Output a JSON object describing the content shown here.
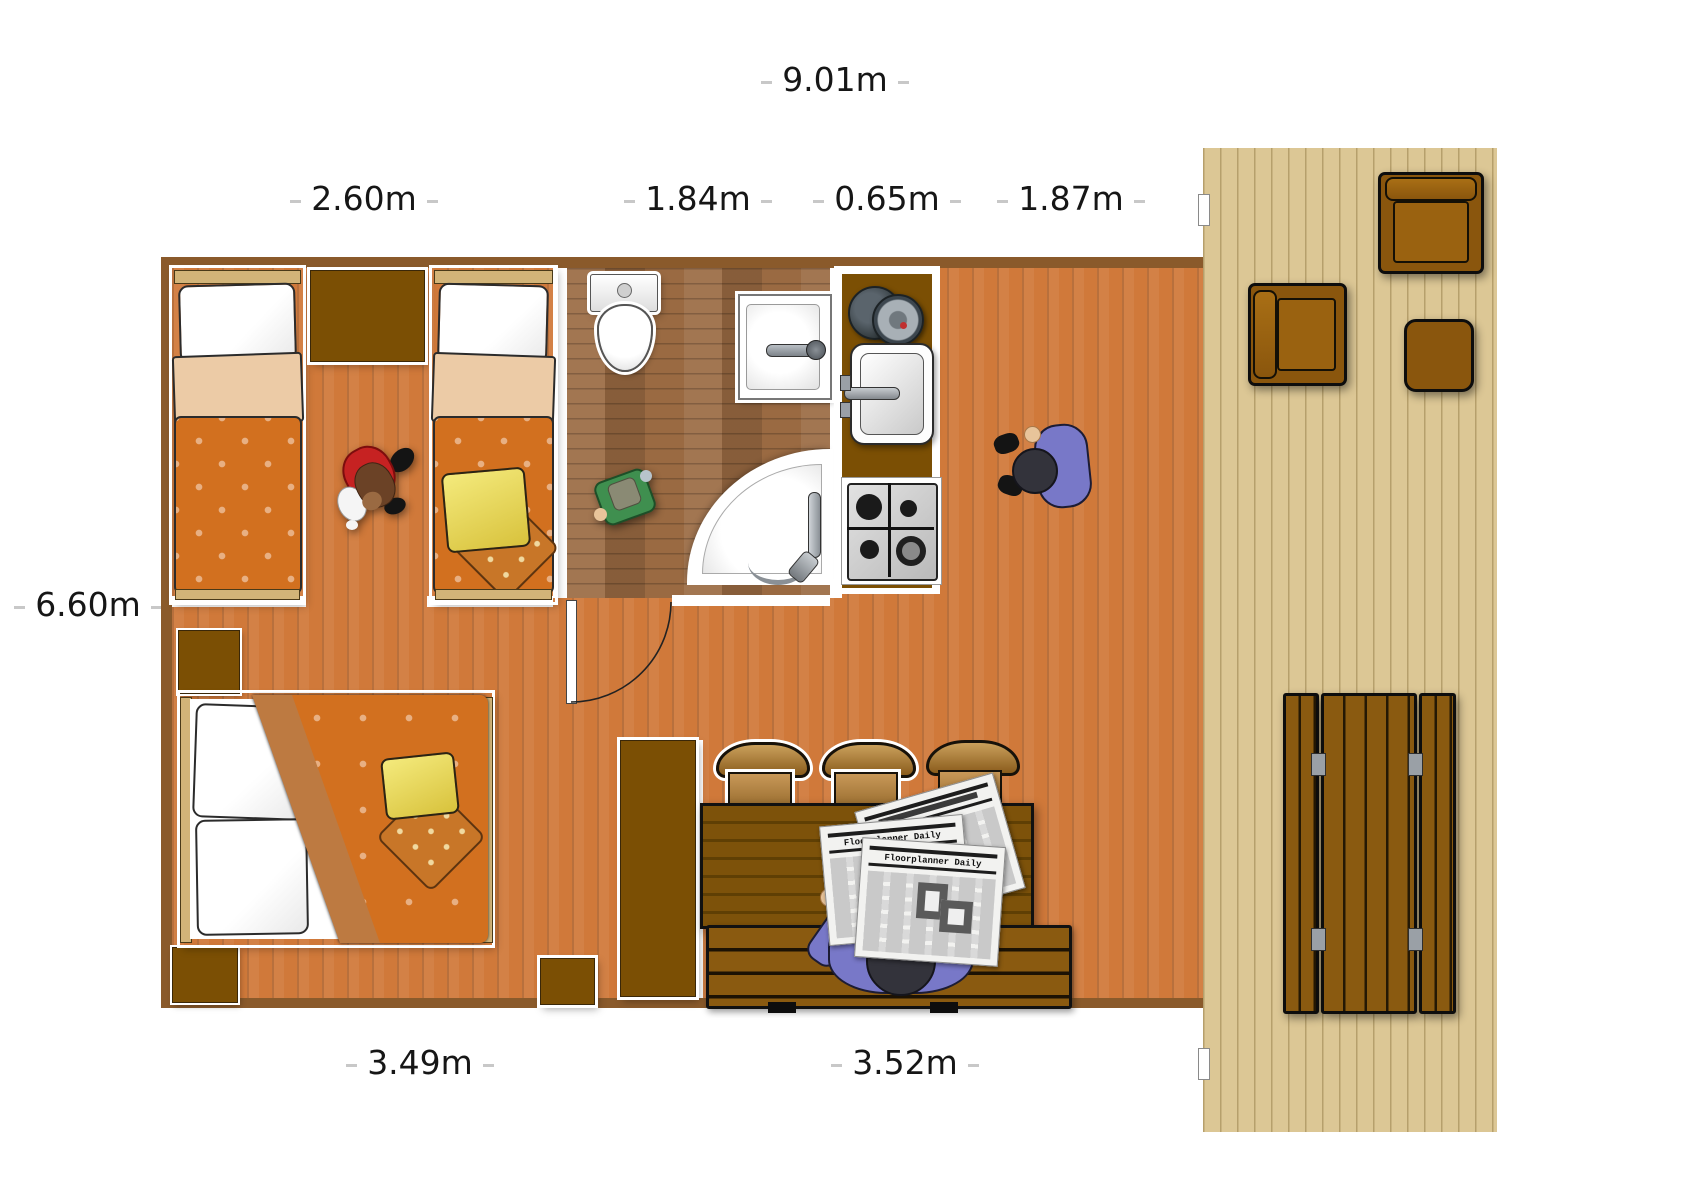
{
  "dimensions": {
    "top_total": "9.01m",
    "seg_bedroom": "2.60m",
    "seg_bathroom": "1.84m",
    "seg_kitchen": "0.65m",
    "seg_living": "1.87m",
    "left_height": "6.60m",
    "bottom_bedroom": "3.49m",
    "bottom_dining": "3.52m"
  },
  "newspaper": {
    "title_front": "Floorplanner Daily",
    "title_middle": "Floorplanner Daily"
  },
  "palette": {
    "floor_wood": "#d0793a",
    "bathroom_parquet": "#9a6a42",
    "deck_wood": "#dcc795",
    "wall_brown": "#8a5a2b",
    "cabinet_brown": "#7b4f04",
    "duvet_orange": "#d2701f",
    "pillow_yellow": "#ecd95a",
    "person_shirt": "#7878c8",
    "chair_wood": "#b98b4a"
  },
  "objects": {
    "bedroom_top": [
      "single-bed",
      "single-bed",
      "wardrobe",
      "dog"
    ],
    "bathroom": [
      "toilet",
      "washbasin",
      "corner-shower",
      "toy"
    ],
    "kitchen": [
      "cooking-pots",
      "kitchen-sink",
      "gas-hob"
    ],
    "bedroom_bottom": [
      "double-bed",
      "nightstand",
      "cabinet",
      "wardrobe"
    ],
    "dining": [
      "dining-table",
      "chair",
      "chair",
      "chair",
      "bench",
      "person-reading-newspaper"
    ],
    "living": [
      "person-standing"
    ],
    "deck": [
      "armchair",
      "armchair",
      "side-table",
      "picnic-table"
    ]
  }
}
